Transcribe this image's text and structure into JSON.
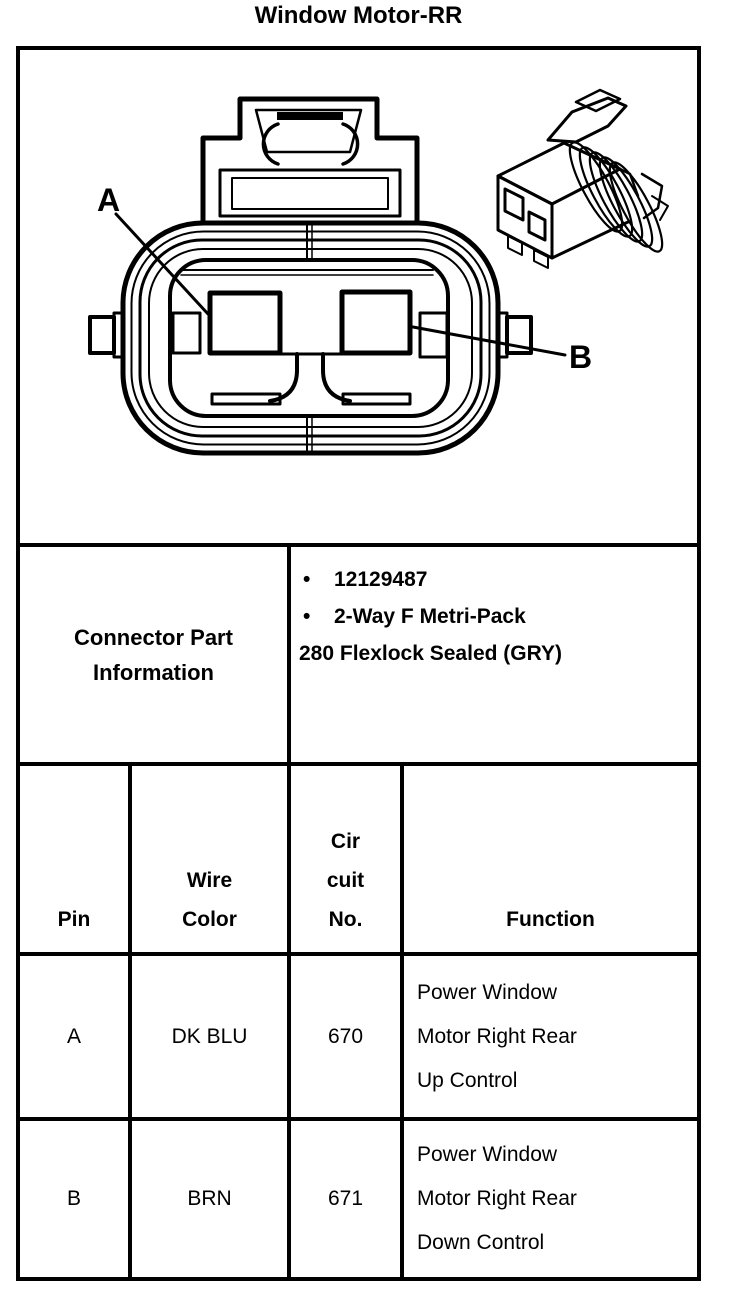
{
  "title": "Window Motor-RR",
  "colors": {
    "ink": "#000000",
    "paper": "#ffffff"
  },
  "diagram": {
    "pin_a_label": "A",
    "pin_b_label": "B"
  },
  "connector_info": {
    "label": [
      "Connector Part",
      "Information"
    ],
    "bullet_glyph": "•",
    "bullets": [
      "12129487",
      "2-Way F Metri-Pack"
    ],
    "continuation": "280 Flexlock Sealed (GRY)"
  },
  "pin_table": {
    "headers": {
      "pin": "Pin",
      "wire_color": [
        "Wire",
        "Color"
      ],
      "circuit": [
        "Cir",
        "cuit",
        "No."
      ],
      "function": "Function"
    },
    "rows": [
      {
        "pin": "A",
        "wire_color": "DK BLU",
        "circuit_no": "670",
        "function": [
          "Power Window",
          "Motor Right Rear",
          "Up Control"
        ]
      },
      {
        "pin": "B",
        "wire_color": "BRN",
        "circuit_no": "671",
        "function": [
          "Power Window",
          "Motor Right Rear",
          "Down Control"
        ]
      }
    ]
  }
}
